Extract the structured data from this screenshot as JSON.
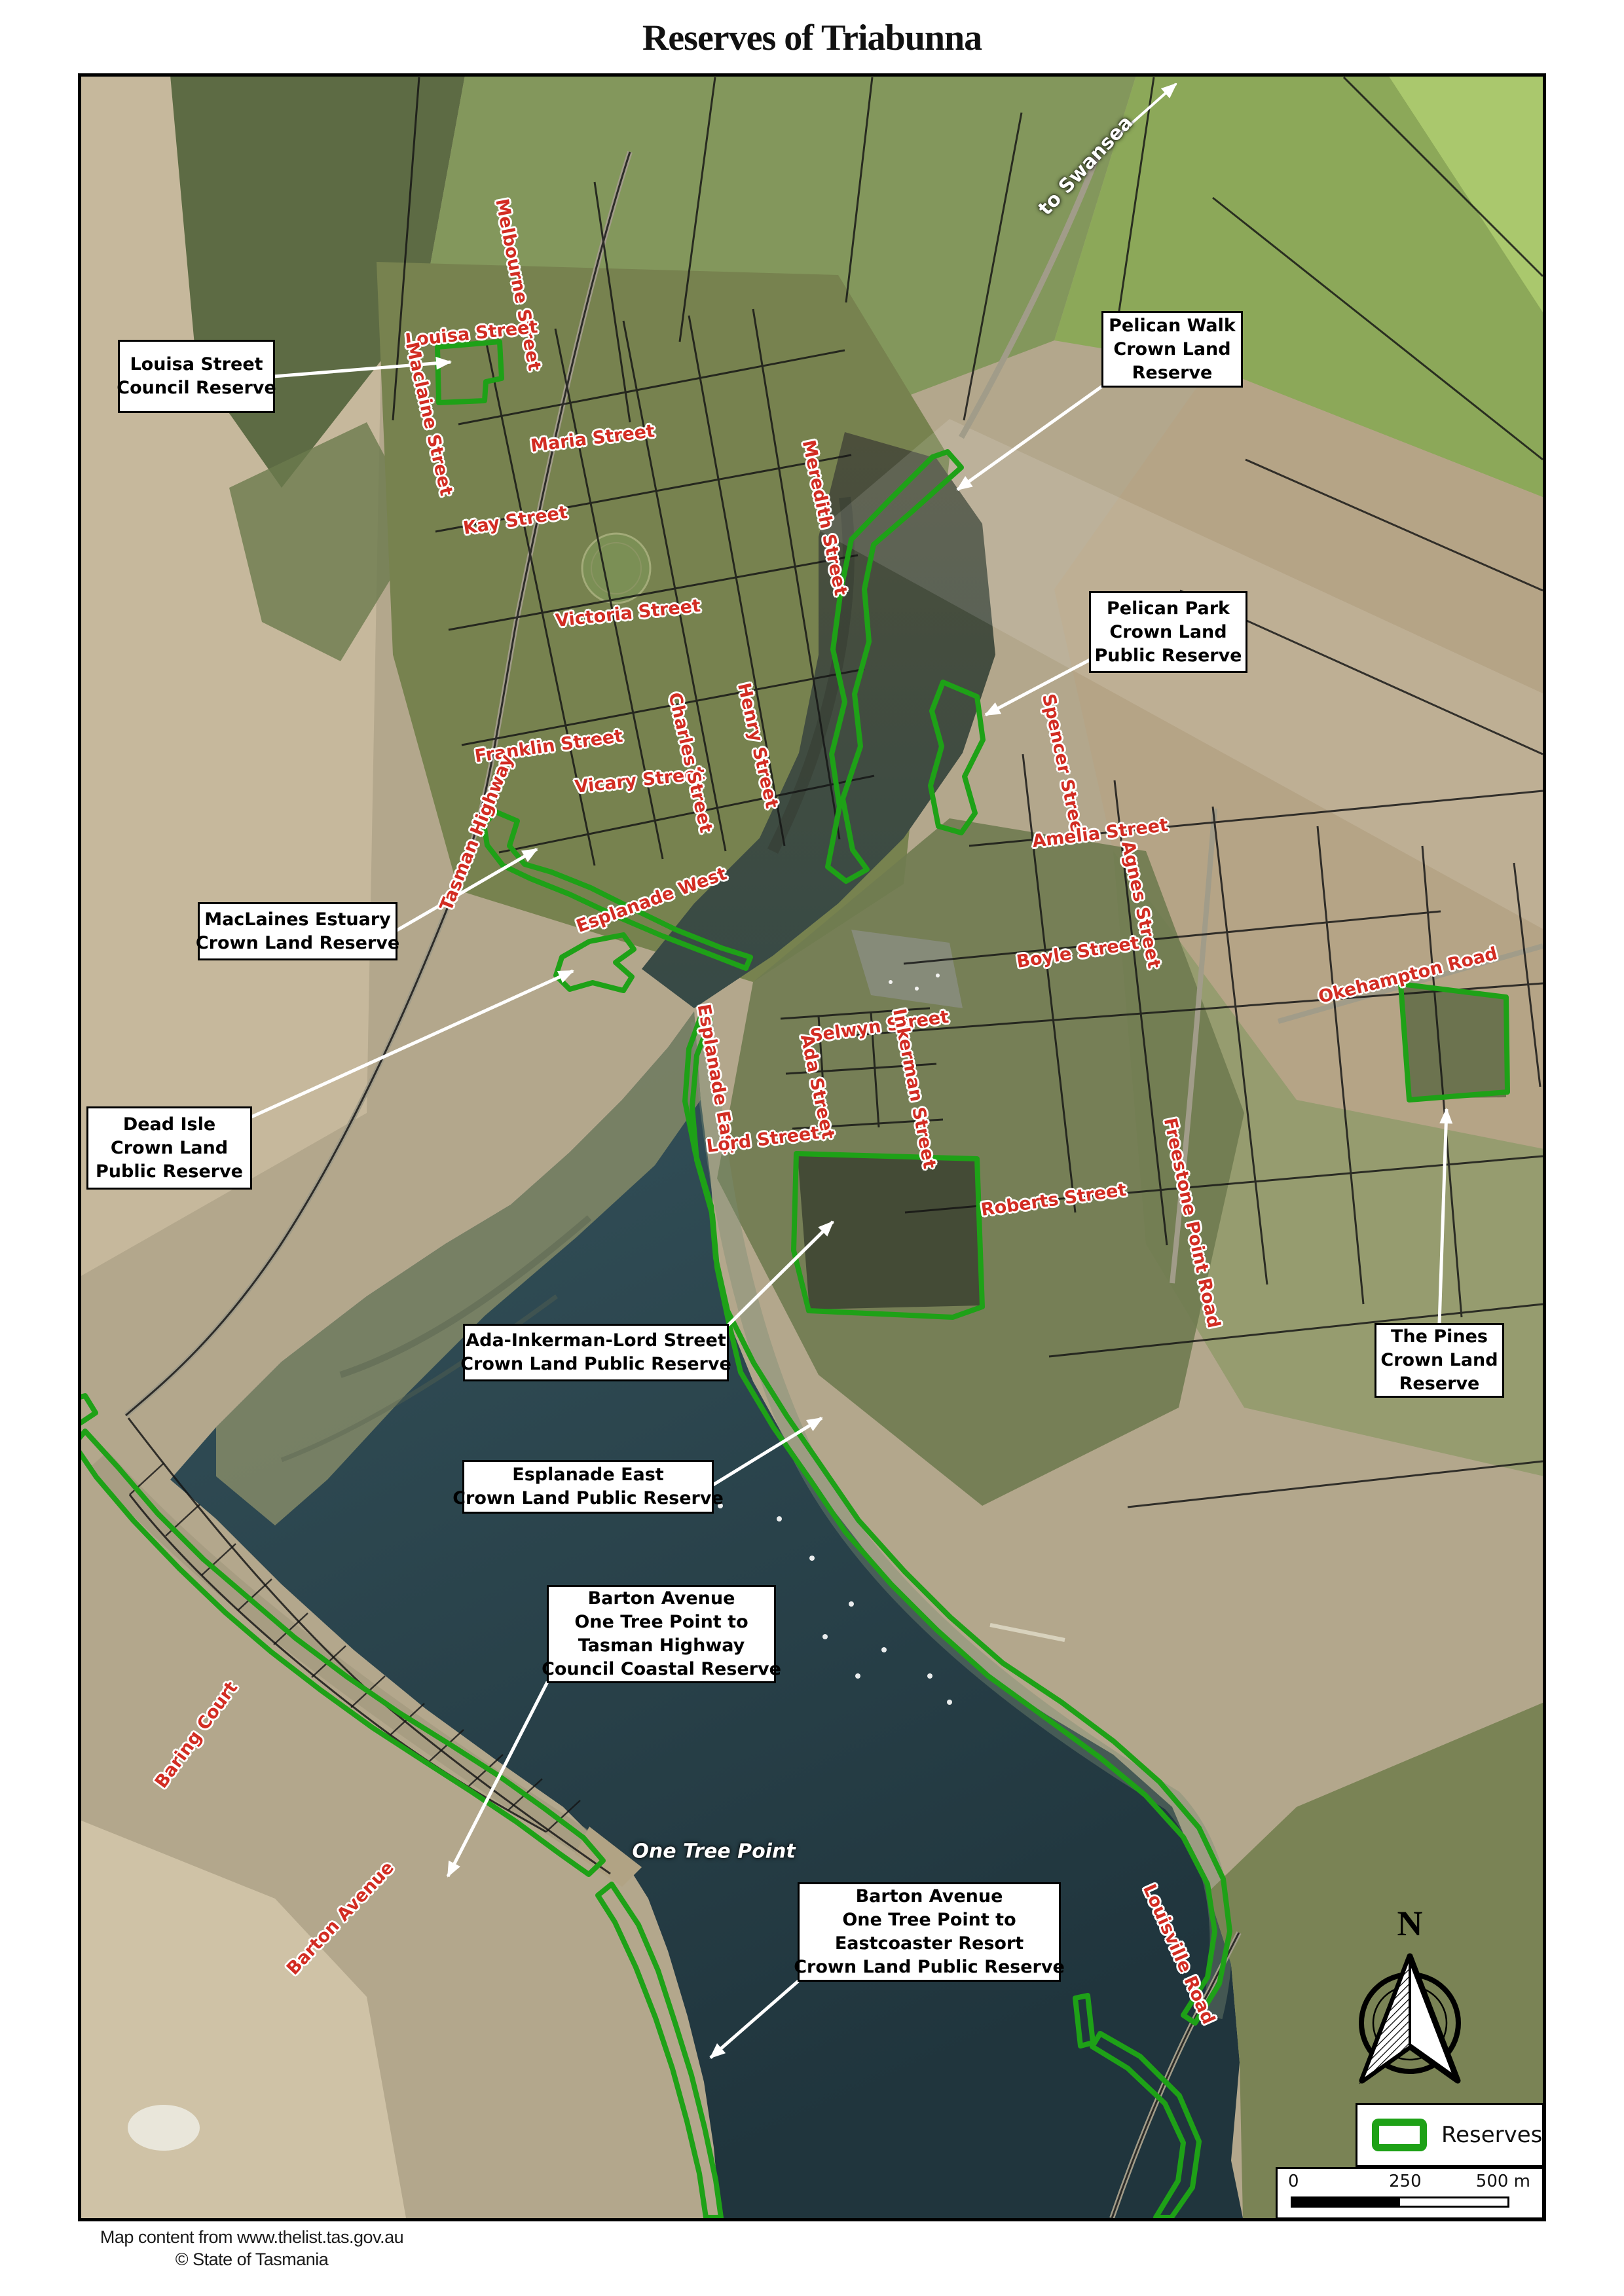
{
  "title": "Reserves of Triabunna",
  "attribution": {
    "line1": "Map content from www.thelist.tas.gov.au",
    "line2": "© State of Tasmania"
  },
  "legend": {
    "label": "Reserves"
  },
  "scale_bar": {
    "start": "0",
    "mid": "250",
    "end": "500 m"
  },
  "north_arrow": {
    "label": "N"
  },
  "colors": {
    "reserve_outline_green": "#1ea117",
    "street_label_red": "#d22c22",
    "callout_background": "#ffffff",
    "callout_border": "#000000"
  },
  "callouts": {
    "louisa": {
      "lines": [
        "Louisa Street",
        "Council Reserve"
      ]
    },
    "pelican_walk": {
      "lines": [
        "Pelican Walk",
        "Crown Land",
        "Reserve"
      ]
    },
    "pelican_park": {
      "lines": [
        "Pelican Park",
        "Crown Land",
        "Public Reserve"
      ]
    },
    "maclaines": {
      "lines": [
        "MacLaines Estuary",
        "Crown Land Reserve"
      ]
    },
    "dead_isle": {
      "lines": [
        "Dead Isle",
        "Crown Land",
        "Public Reserve"
      ]
    },
    "ada_inkerman": {
      "lines": [
        "Ada-Inkerman-Lord Street",
        "Crown Land Public Reserve"
      ]
    },
    "esplanade_east": {
      "lines": [
        "Esplanade East",
        "Crown Land Public Reserve"
      ]
    },
    "barton_tasman": {
      "lines": [
        "Barton Avenue",
        "One Tree Point to",
        "Tasman Highway",
        "Council Coastal Reserve"
      ]
    },
    "pines": {
      "lines": [
        "The Pines",
        "Crown Land",
        "Reserve"
      ]
    },
    "barton_eastcoaster": {
      "lines": [
        "Barton Avenue",
        "One Tree Point to",
        "Eastcoaster Resort",
        "Crown Land Public Reserve"
      ]
    }
  },
  "streets": {
    "melbourne": "Melbourne Street",
    "louisa": "Louisa Street",
    "maclaine": "Maclaine Street",
    "maria": "Maria Street",
    "kay": "Kay Street",
    "victoria": "Victoria Street",
    "franklin": "Franklin Street",
    "vicary": "Vicary Street",
    "charles": "Charles Street",
    "henry": "Henry Street",
    "meredith": "Meredith Street",
    "tasman": "Tasman Highway",
    "esplanade_west": "Esplanade West",
    "spencer": "Spencer Street",
    "amelia": "Amelia Street",
    "agnes": "Agnes Street",
    "boyle": "Boyle Street",
    "selwyn": "Selwyn Street",
    "inkerman": "Inkerman Street",
    "roberts": "Roberts Street",
    "esplanade_east": "Esplanade East",
    "ada": "Ada Street",
    "lord": "Lord Street",
    "okehampton": "Okehampton Road",
    "freestone_point": "Freestone Point Road",
    "baring": "Baring Court",
    "barton": "Barton Avenue",
    "louisville": "Louisville Road"
  },
  "map_labels": {
    "to_swansea": "to Swansea",
    "one_tree_point": "One Tree Point"
  }
}
